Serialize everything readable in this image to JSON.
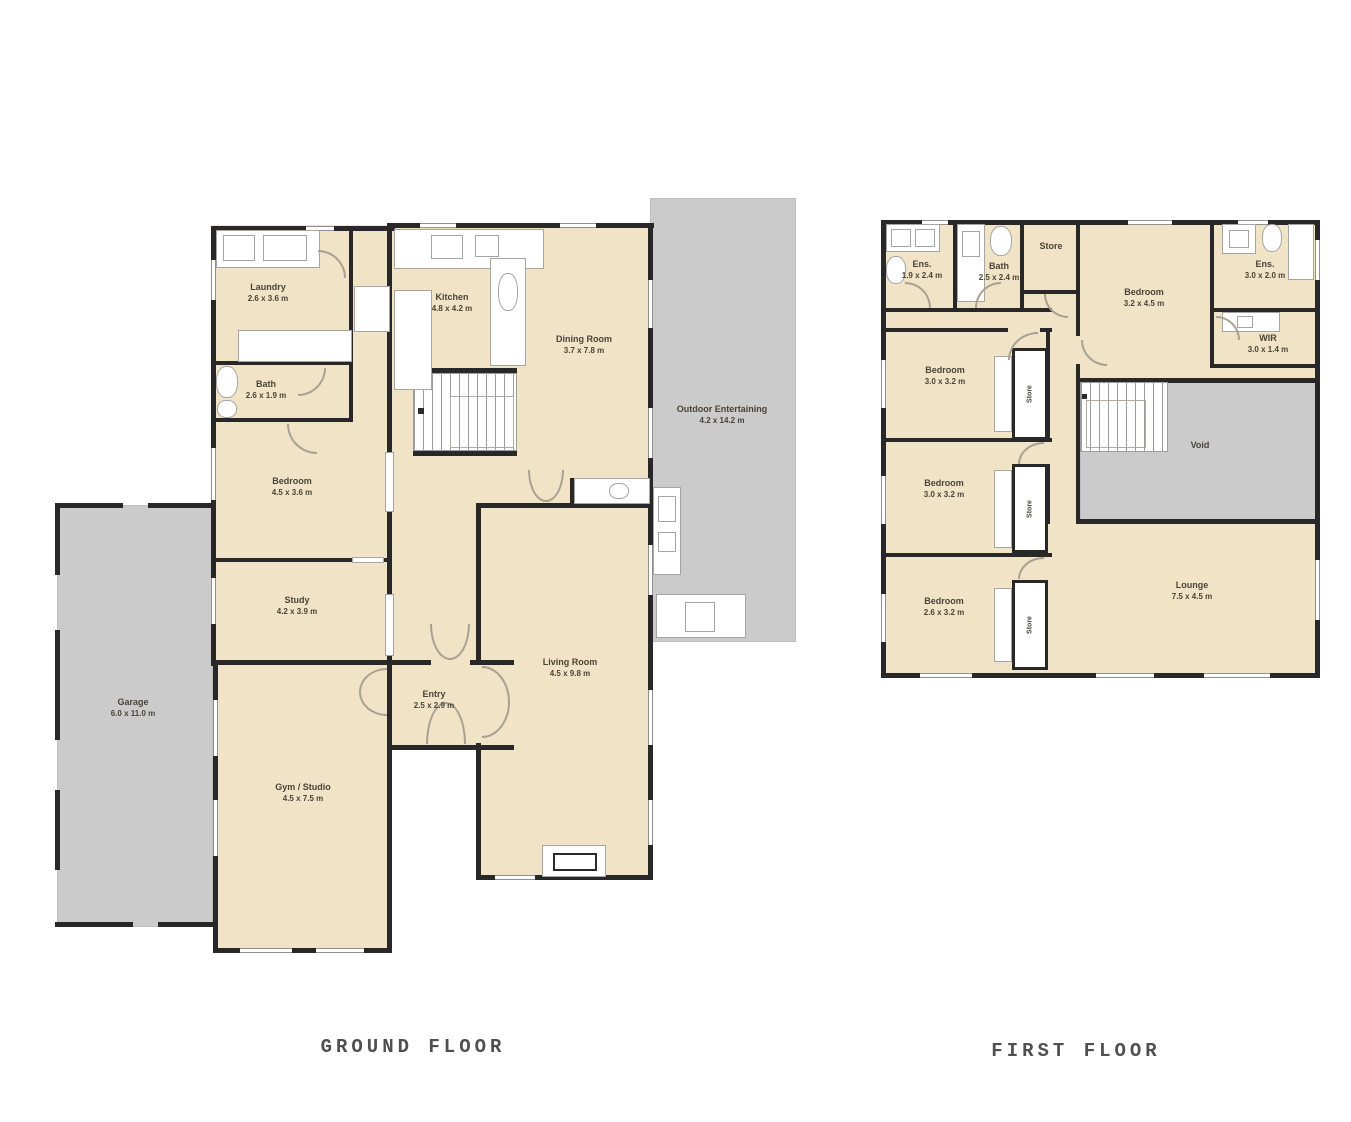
{
  "ground_floor": {
    "title": "GROUND FLOOR",
    "rooms": {
      "laundry": {
        "name": "Laundry",
        "dims": "2.6 x 3.6 m"
      },
      "bath": {
        "name": "Bath",
        "dims": "2.6 x 1.9 m"
      },
      "kitchen": {
        "name": "Kitchen",
        "dims": "4.8 x 4.2 m"
      },
      "dining_room": {
        "name": "Dining Room",
        "dims": "3.7 x 7.8 m"
      },
      "outdoor_entertaining": {
        "name": "Outdoor Entertaining",
        "dims": "4.2 x 14.2 m"
      },
      "bedroom": {
        "name": "Bedroom",
        "dims": "4.5 x 3.6 m"
      },
      "study": {
        "name": "Study",
        "dims": "4.2 x 3.9 m"
      },
      "garage": {
        "name": "Garage",
        "dims": "6.0 x 11.0 m"
      },
      "gym_studio": {
        "name": "Gym / Studio",
        "dims": "4.5 x 7.5 m"
      },
      "entry": {
        "name": "Entry",
        "dims": "2.5 x 2.9 m"
      },
      "living_room": {
        "name": "Living Room",
        "dims": "4.5 x 9.8 m"
      }
    }
  },
  "first_floor": {
    "title": "FIRST FLOOR",
    "rooms": {
      "ensuite_left": {
        "name": "Ens.",
        "dims": "1.9 x 2.4 m"
      },
      "bath": {
        "name": "Bath",
        "dims": "2.5 x 2.4 m"
      },
      "store_hall": {
        "name": "Store"
      },
      "bedroom_main": {
        "name": "Bedroom",
        "dims": "3.2 x 4.5 m"
      },
      "ensuite_right": {
        "name": "Ens.",
        "dims": "3.0 x 2.0 m"
      },
      "wir": {
        "name": "WIR",
        "dims": "3.0 x 1.4 m"
      },
      "bedroom_2": {
        "name": "Bedroom",
        "dims": "3.0 x 3.2 m"
      },
      "bedroom_3": {
        "name": "Bedroom",
        "dims": "3.0 x 3.2 m"
      },
      "bedroom_4": {
        "name": "Bedroom",
        "dims": "2.6 x 3.2 m"
      },
      "store_1": {
        "name": "Store"
      },
      "store_2": {
        "name": "Store"
      },
      "store_3": {
        "name": "Store"
      },
      "void": {
        "name": "Void"
      },
      "lounge": {
        "name": "Lounge",
        "dims": "7.5 x 4.5 m"
      }
    }
  },
  "colors": {
    "floor_fill": "#f0e3c6",
    "paved_fill": "#cbcbcb",
    "wall": "#282828"
  }
}
